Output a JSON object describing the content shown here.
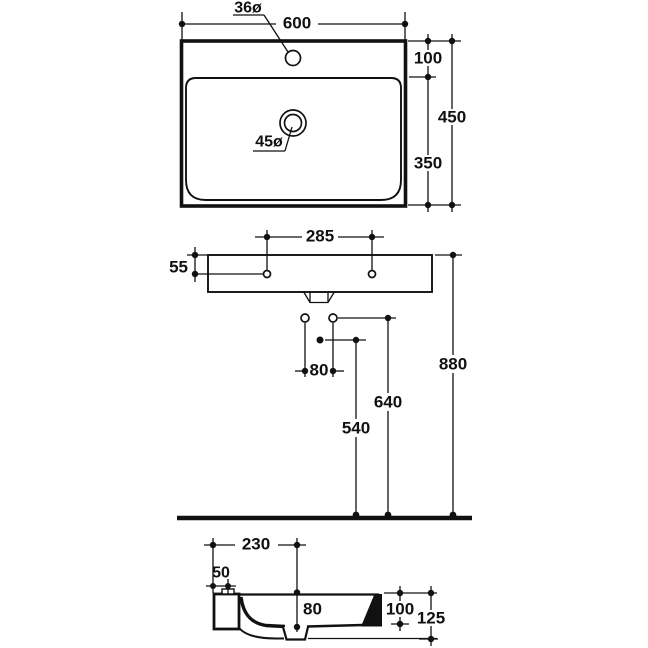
{
  "drawing": {
    "type": "technical-dimension-drawing",
    "subject": "wall-hung washbasin, three views (plan, front elevation with connections, side section)",
    "colors": {
      "line": "#111111",
      "background": "#ffffff"
    },
    "labels": {
      "tap_hole_diameter": "36ø",
      "overall_width": "600",
      "rim_to_bowl_front": "100",
      "overall_depth": "450",
      "waste_hole_diameter": "45ø",
      "bowl_front_to_back": "350",
      "fixing_hole_spacing": "285",
      "fixing_hole_drop": "55",
      "supply_spacing": "80",
      "drain_center_height": "540",
      "supply_height": "640",
      "rim_height": "880",
      "waste_offset_from_wall": "230",
      "fixing_tab_width": "50",
      "bowl_inner_depth": "80",
      "body_height": "100",
      "overall_height": "125"
    },
    "dimensions_mm": {
      "tap_hole_diameter": 36,
      "overall_width": 600,
      "rim_to_bowl_front": 100,
      "overall_depth": 450,
      "waste_hole_diameter": 45,
      "bowl_front_to_back": 350,
      "fixing_hole_spacing": 285,
      "fixing_hole_drop": 55,
      "supply_spacing": 80,
      "drain_center_height": 540,
      "supply_height": 640,
      "rim_height": 880,
      "waste_offset_from_wall": 230,
      "fixing_tab_width": 50,
      "bowl_inner_depth": 80,
      "body_height": 100,
      "overall_height": 125
    }
  }
}
